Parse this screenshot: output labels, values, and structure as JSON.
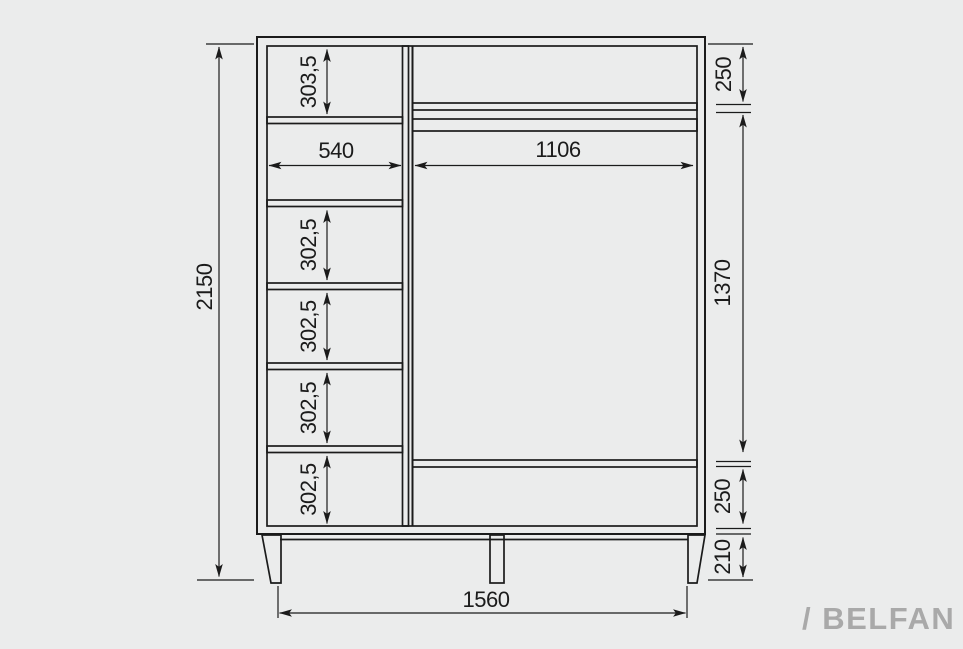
{
  "drawing": {
    "kind": "wardrobe-dimension-drawing",
    "background_color": "#ebecec",
    "line_color": "#1b1b1b"
  },
  "brand": {
    "text": "/ BELFAN",
    "color": "#a9a9a9"
  },
  "dims": {
    "overall_height": "2150",
    "base_width": "1560",
    "legs_height": "210",
    "left_column": {
      "width": "540",
      "top_compartment_height": "303,5",
      "shelf_heights": [
        "302,5",
        "302,5",
        "302,5",
        "302,5"
      ]
    },
    "right_section": {
      "width": "1106",
      "top_height": "250",
      "middle_height": "1370",
      "bottom_height": "250"
    }
  }
}
